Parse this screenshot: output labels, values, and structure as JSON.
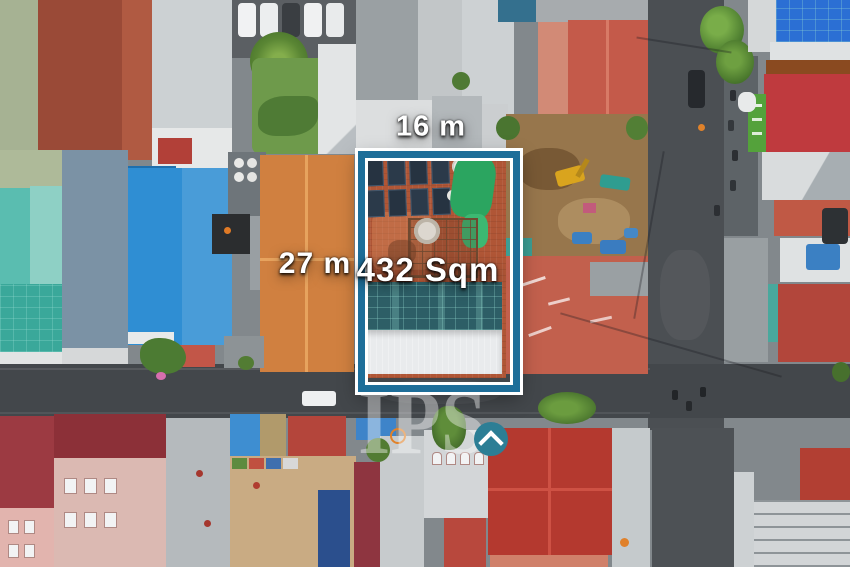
{
  "annotations": {
    "frontage_label": "16 m",
    "depth_label": "27 m",
    "area_label": "432 Sqm"
  },
  "watermark": {
    "text": "IPS",
    "icon": "roof-chevron-icon"
  },
  "colors": {
    "boundary_accent": "#1e6e99",
    "boundary_outline": "#ffffff",
    "label_text": "#ffffff",
    "watermark_badge_teal": "#2c7e95",
    "watermark_text_white": "#ffffff"
  }
}
